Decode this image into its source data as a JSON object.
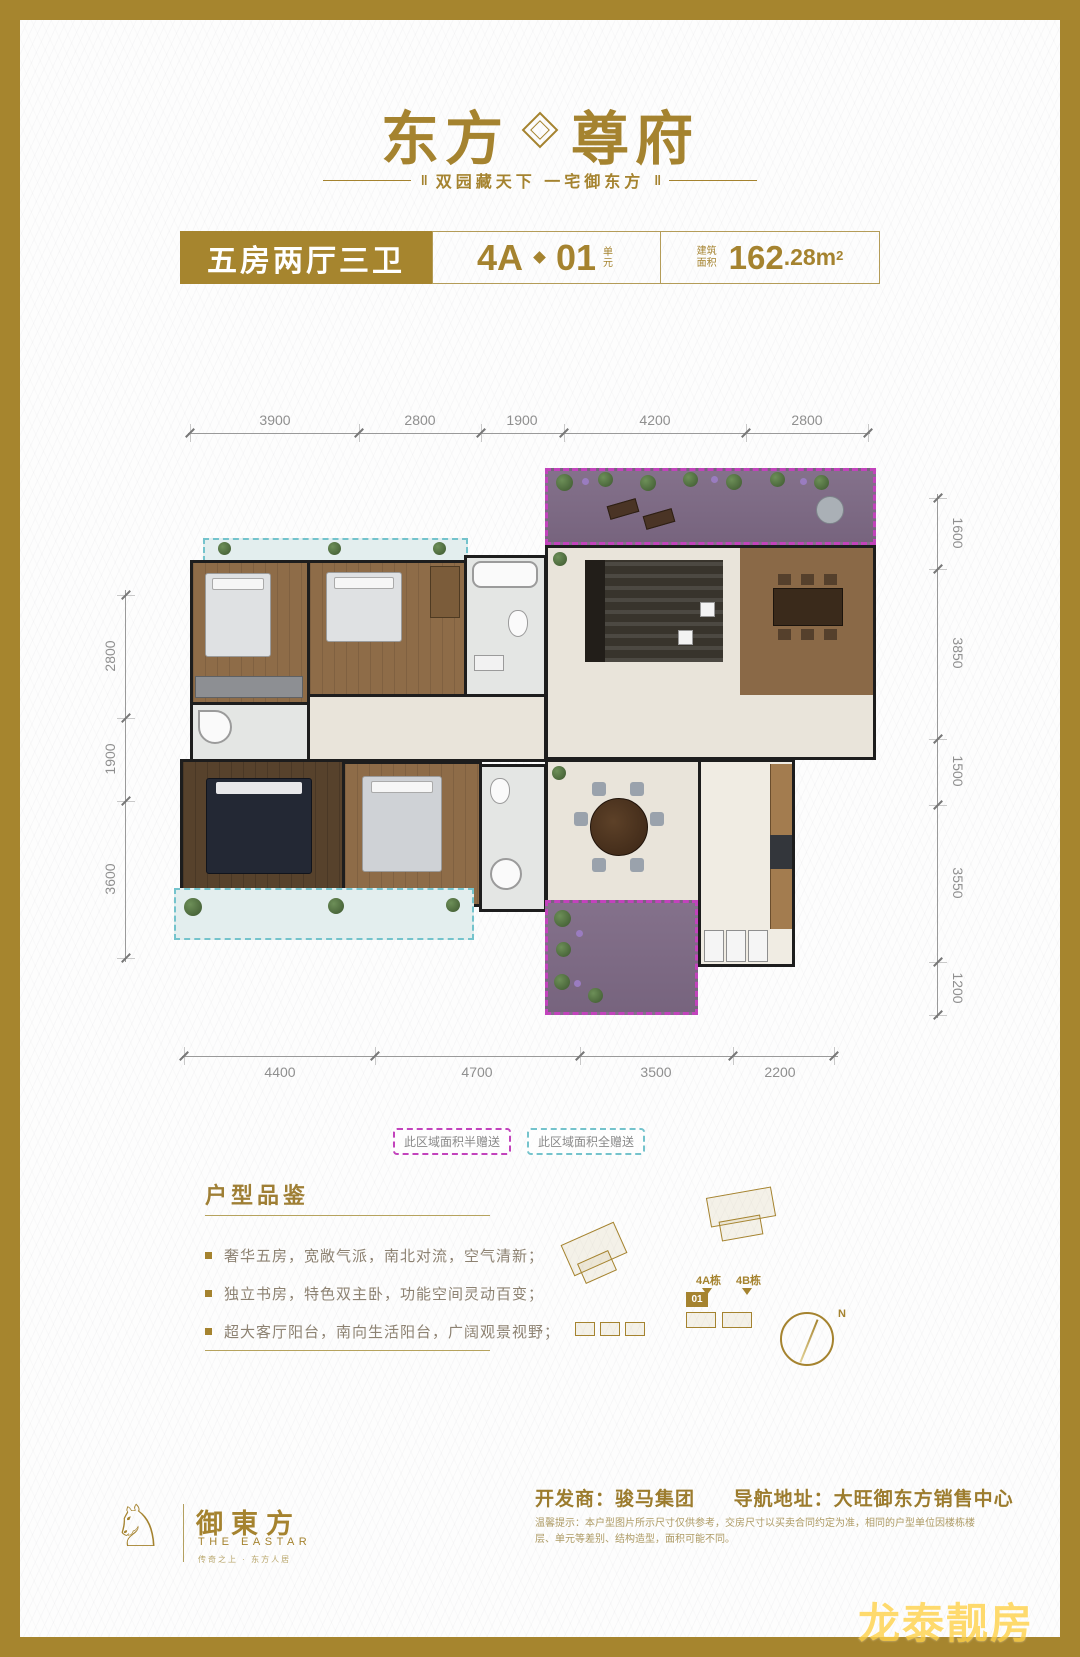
{
  "colors": {
    "gold": "#a5832f",
    "magenta_dashed": "#c243bc",
    "teal_dashed": "#74c3cc",
    "purple_floor": "#7d6b84",
    "dim_text": "#8f8f8f"
  },
  "brand": {
    "name_left": "东方",
    "name_right": "尊府",
    "tagline": "双园藏天下  一宅御东方",
    "ornament": "‖"
  },
  "spec": {
    "layout_title": "五房两厅三卫",
    "unit_block": "4A",
    "unit_no": "01",
    "unit_label": "单元",
    "area_label": "建筑面积",
    "area_int": "162",
    "area_dec": ".28",
    "area_unit": "m",
    "area_sup": "2"
  },
  "dims": {
    "top": [
      "3900",
      "2800",
      "1900",
      "4200",
      "2800"
    ],
    "bottom": [
      "4400",
      "4700",
      "3500",
      "2200"
    ],
    "left": [
      "2800",
      "1900",
      "3600"
    ],
    "right": [
      "1600",
      "3850",
      "1500",
      "3550",
      "1200"
    ]
  },
  "legend": {
    "half": "此区域面积半赠送",
    "full": "此区域面积全赠送"
  },
  "features": {
    "title": "户型品鉴",
    "items": [
      "奢华五房，宽敞气派，南北对流，空气清新；",
      "独立书房，特色双主卧，功能空间灵动百变；",
      "超大客厅阳台，南向生活阳台，广阔观景视野；"
    ]
  },
  "site": {
    "tower_a": "4A栋",
    "tower_b": "4B栋",
    "unit_tag": "01",
    "compass": "N"
  },
  "footer": {
    "logo_cn": "御東方",
    "logo_en": "THE EASTAR",
    "logo_sub": "传奇之上 · 东方人居",
    "developer": "开发商：骏马集团",
    "navigation": "导航地址：大旺御东方销售中心",
    "disclaimer": "温馨提示：本户型图片所示尺寸仅供参考，交房尺寸以买卖合同约定为准，相同的户型单位因楼栋楼层、单元等差别、结构造型，面积可能不同。"
  },
  "watermark": "龙泰靓房"
}
